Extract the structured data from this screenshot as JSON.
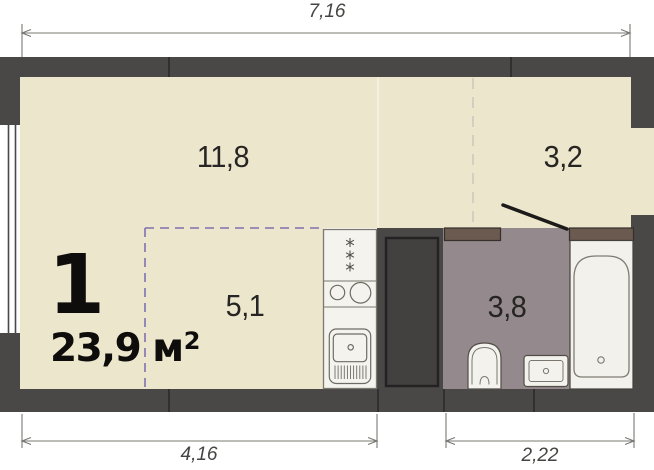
{
  "unit": {
    "number": "1",
    "area_value": "23,9 м",
    "area_sup": "2"
  },
  "rooms": {
    "living": {
      "area": "11,8"
    },
    "hall": {
      "area": "3,2"
    },
    "kitchen": {
      "area": "5,1"
    },
    "bathroom": {
      "area": "3,8"
    }
  },
  "dimensions": {
    "top": "7,16",
    "bottom_left": "4,16",
    "bottom_right": "2,22"
  },
  "colors": {
    "wall": "#4a4747",
    "floor_main": "#ece7cc",
    "floor_wet": "#948a8e",
    "lintel_brown": "#6b5a50",
    "kitchen_zone_dash": "#7e71b0",
    "hall_zone_dash": "#ccc8be",
    "fixture_white": "#f4f2ed"
  }
}
